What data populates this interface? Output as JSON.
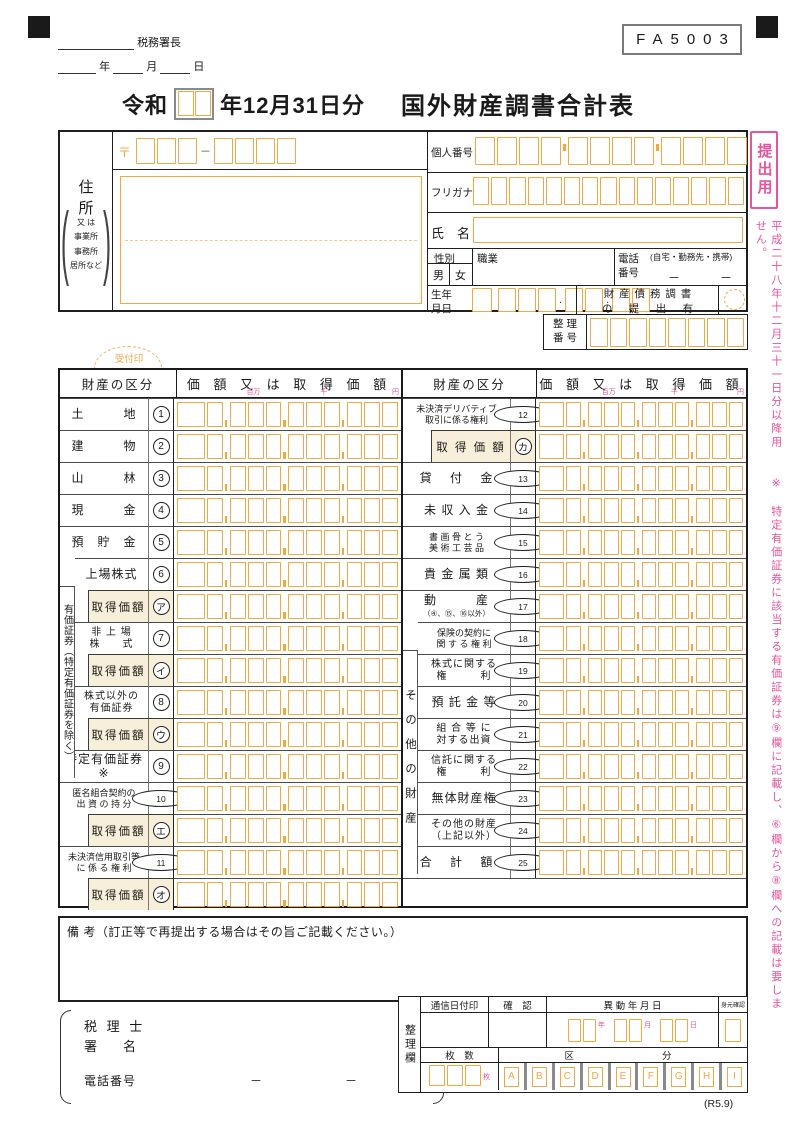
{
  "page": {
    "form_code": "FA5003",
    "revision": "(R5.9)"
  },
  "top": {
    "tax_office": "税務署長",
    "year": "年",
    "month": "月",
    "day": "日"
  },
  "title": {
    "era": "令和",
    "date_suffix": "年12月31日分",
    "main": "国外財産調書合計表"
  },
  "side": {
    "tag": "提出用",
    "note": "平成二十八年十二月三十一日分以降用　　※　特定有価証券に該当する有価証券は⑨欄に記載し、⑥欄から⑧欄への記載は要しません。"
  },
  "info": {
    "address_label": "住　所",
    "address_alt": "又 は\n事業所\n事務所\n居所など",
    "postal_mark": "〒",
    "postal_dash": "－",
    "my_number_label": "個人番号",
    "furigana_label": "フリガナ",
    "name_label": "氏　名",
    "gender_label": "性別",
    "male": "男",
    "female": "女",
    "occupation_label": "職業",
    "phone_label": "電話\n番号",
    "phone_note": "(自宅・勤務先・携帯)",
    "phone_dash1": "－",
    "phone_dash2": "－",
    "birth_label": "生年\n月日",
    "dot": ".",
    "property_debt_report": "財 産 債 務 調 書\nの　 提　 出　 有",
    "ref_number_label": "整 理\n番 号"
  },
  "stamp": {
    "label": "受付印"
  },
  "table": {
    "division_header": "財産の区分",
    "amount_header": "価 額 又 は 取 得 価 額",
    "u_million": "百万",
    "u_thousand": "千",
    "u_yen": "円",
    "left_group": "有価証券（特定有価証券を除く）",
    "right_group": "その他の財産",
    "left_rows": [
      {
        "num": "1",
        "label": "土　　　地"
      },
      {
        "num": "2",
        "label": "建　　　物"
      },
      {
        "num": "3",
        "label": "山　　　林"
      },
      {
        "num": "4",
        "label": "現　　　金"
      },
      {
        "num": "5",
        "label": "預　貯　金"
      },
      {
        "num": "6",
        "label": "上場株式",
        "grouped": true
      },
      {
        "num": "ア",
        "label": "取得価額",
        "acq": true,
        "grouped": true
      },
      {
        "num": "7",
        "label": "非 上 場\n株　　式",
        "grouped": true
      },
      {
        "num": "イ",
        "label": "取得価額",
        "acq": true,
        "grouped": true
      },
      {
        "num": "8",
        "label": "株式以外の\n有価証券",
        "grouped": true
      },
      {
        "num": "ウ",
        "label": "取得価額",
        "acq": true,
        "grouped": true
      },
      {
        "num": "9",
        "label": "特定有価証券※"
      },
      {
        "num": "10",
        "label": "匿名組合契約の\n出 資 の 持 分"
      },
      {
        "num": "エ",
        "label": "取得価額",
        "acq": true
      },
      {
        "num": "11",
        "label": "未決済信用取引等\nに 係 る 権 利"
      },
      {
        "num": "オ",
        "label": "取得価額",
        "acq": true
      }
    ],
    "right_rows": [
      {
        "num": "12",
        "label": "未決済デリバティブ\n取引に係る権利"
      },
      {
        "num": "カ",
        "label": "取 得 価 額",
        "acq": true
      },
      {
        "num": "13",
        "label": "貸　 付　 金"
      },
      {
        "num": "14",
        "label": "未 収 入 金"
      },
      {
        "num": "15",
        "label": "書 画 骨 と う\n美 術 工 芸 品"
      },
      {
        "num": "16",
        "label": "貴 金 属 類"
      },
      {
        "num": "17",
        "label": "動　　　産",
        "sub": "（④、⑮、⑯以外）"
      },
      {
        "num": "18",
        "label": "保険の契約に\n関 す る 権 利",
        "grouped": true
      },
      {
        "num": "19",
        "label": "株式に関する\n権　　　利",
        "grouped": true
      },
      {
        "num": "20",
        "label": "預 託 金 等",
        "grouped": true
      },
      {
        "num": "21",
        "label": "組 合 等 に\n対する出資",
        "grouped": true
      },
      {
        "num": "22",
        "label": "信託に関する\n権　　　利",
        "grouped": true
      },
      {
        "num": "23",
        "label": "無体財産権",
        "grouped": true
      },
      {
        "num": "24",
        "label": "その他の財産\n（上記以外）",
        "grouped": true
      },
      {
        "num": "25",
        "label": "合　 計　 額"
      },
      {
        "empty": true
      }
    ]
  },
  "remarks": "備 考（訂正等で再提出する場合はその旨ご記載ください。）",
  "footer": {
    "tax_acct_line1": "税 理 士",
    "tax_acct_line2": "署　　名",
    "phone_label": "電話番号",
    "dash1": "－",
    "dash2": "－",
    "seiri_ran": "整理欄",
    "postmark": "通信日付印",
    "confirm": "確　認",
    "change_date": "異 動 年 月 日",
    "id_check": "身元確認",
    "sheets_label": "枚　数",
    "kubun_label": "区　　　　分",
    "y": "年",
    "m": "月",
    "d": "日",
    "sheet_unit": "枚",
    "letters": [
      "A",
      "B",
      "C",
      "D",
      "E",
      "F",
      "G",
      "H",
      "I"
    ]
  }
}
